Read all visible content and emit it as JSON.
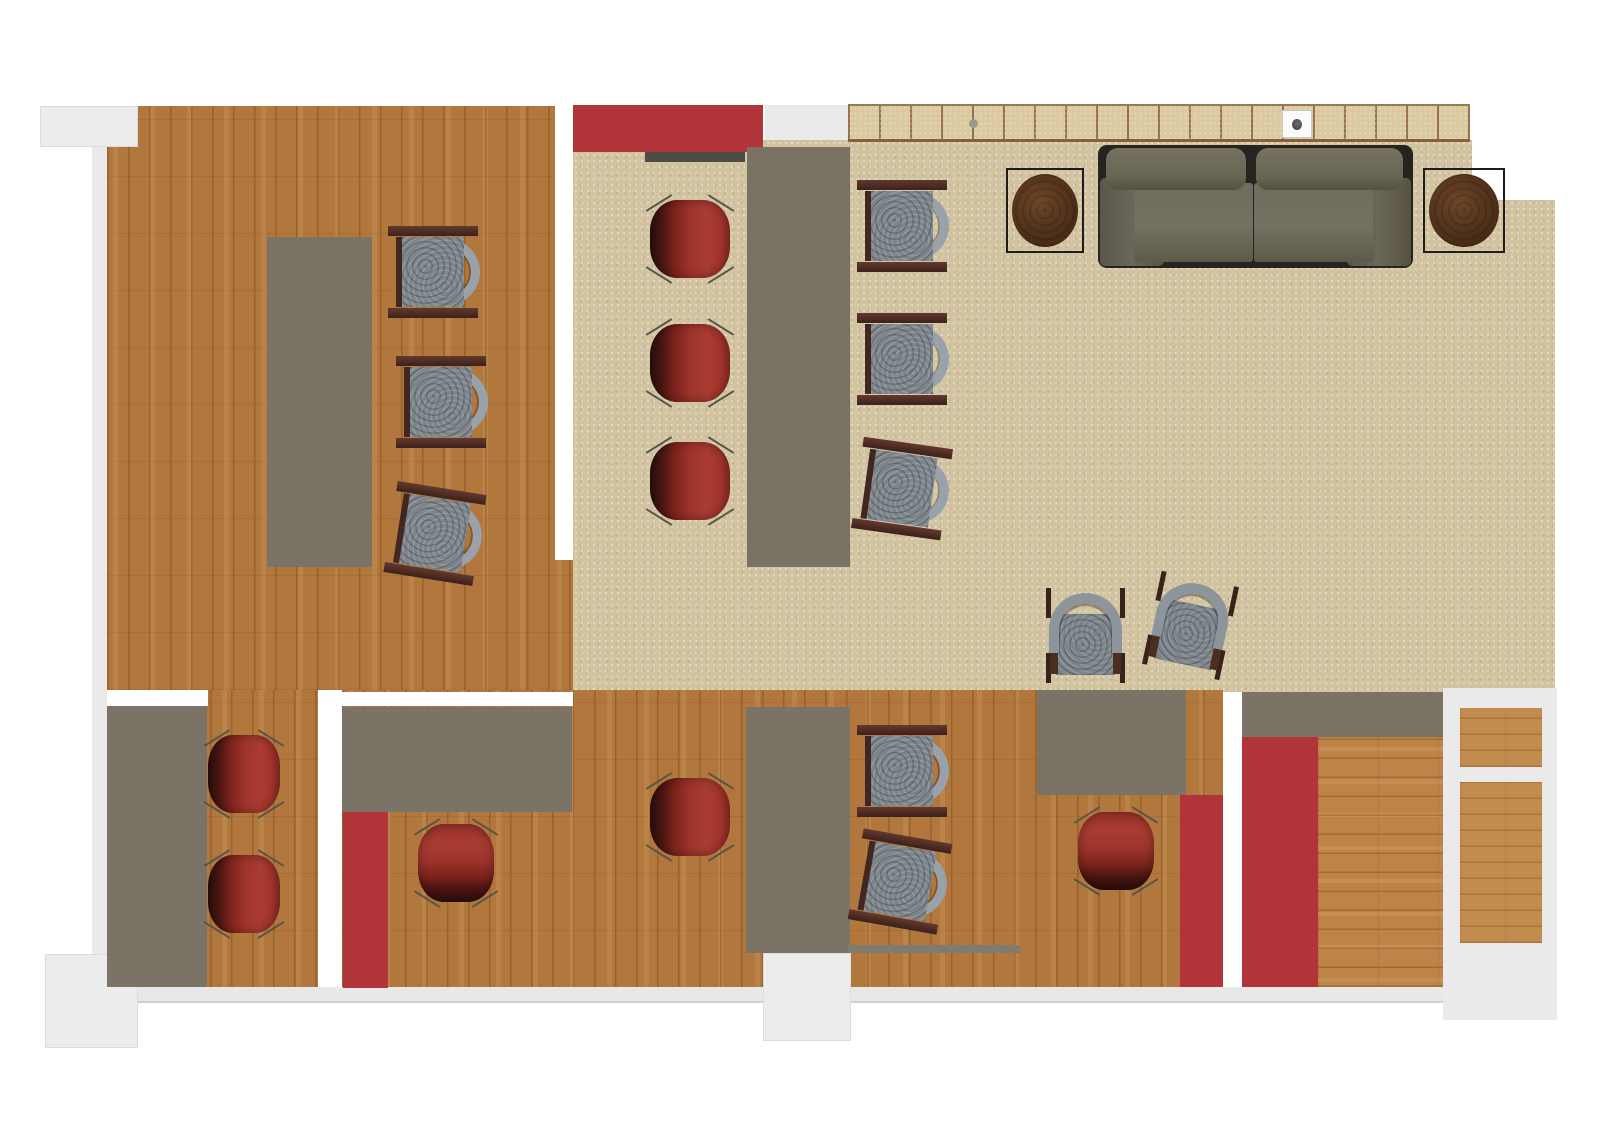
{
  "document": {
    "type": "architectural-floor-plan",
    "view": "top-down",
    "visible_text": "",
    "canvas": {
      "width_px": 1612,
      "height_px": 1140
    }
  },
  "palette": {
    "page_background": "#ffffff",
    "wood_floor": "#b1773c",
    "wood_floor_light": "#bd8347",
    "carpet": "#d2c3a1",
    "tile_wall": "#dbc9a0",
    "tile_grout": "#96714a",
    "desk_gray": "#7b7366",
    "accent_red": "#b13438",
    "sofa_olive": "#6c685b",
    "chair_red": "#9e352c",
    "chair_gray_seat": "#7d858b",
    "chair_arm_gray": "#99a2aa",
    "chair_wood_frame": "#432620",
    "side_table_brown": "#50311a",
    "outside_wall_gray": "#ececec",
    "wall_white": "#ffffff"
  },
  "rooms": [
    {
      "name": "office-top-left",
      "floor": "wood",
      "furniture": [
        "long desk",
        "gray office chair x3 (one tilted)"
      ]
    },
    {
      "name": "meeting-area-center",
      "floor": "carpet",
      "furniture": [
        "red wall panel",
        "wall board",
        "long conference table",
        "red tub chair x3 (left side)",
        "gray office chair x3 (right side, one tilted)"
      ]
    },
    {
      "name": "lounge-top-right",
      "floor": "carpet",
      "furniture": [
        "tiled counter wall with power outlet",
        "two-seat sofa",
        "square side table with round top x2",
        "arch-back lounge chair x2 (one tilted)"
      ]
    },
    {
      "name": "office-bottom-left",
      "floor": "wood",
      "furniture": [
        "corner desk",
        "red tub chair x2"
      ]
    },
    {
      "name": "office-bottom-middle",
      "floor": "wood",
      "furniture": [
        "desk",
        "red floor strip",
        "red tub chair x2",
        "tall desk column",
        "doorway recess"
      ]
    },
    {
      "name": "office-bottom-right",
      "floor": "wood",
      "furniture": [
        "gray office chair x2 (one tilted)",
        "desk",
        "red accent column",
        "red tub chair",
        "wall ledge"
      ]
    },
    {
      "name": "closet-far-right",
      "floor": "outside-gray",
      "furniture": [
        "wood mat x2"
      ]
    }
  ],
  "furniture_totals": {
    "red_tub_chairs": 8,
    "gray_office_chairs": 8,
    "arch_back_lounge_chairs": 2,
    "sofas": 1,
    "round_side_tables": 2,
    "desks_tables": 7
  }
}
